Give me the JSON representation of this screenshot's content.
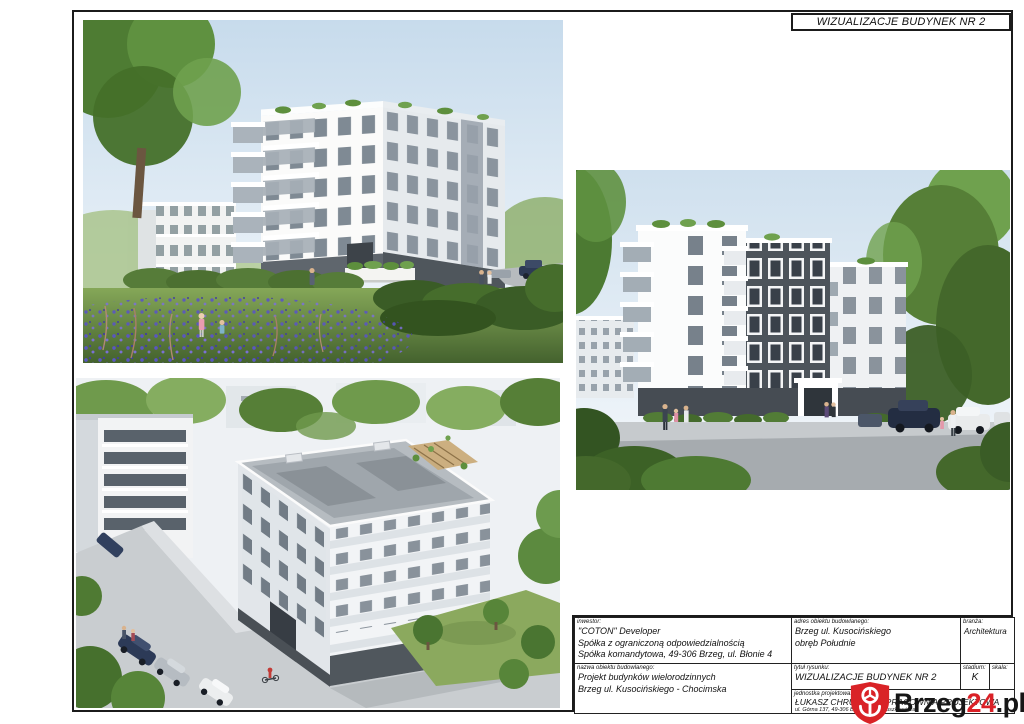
{
  "sheet": {
    "header_title": "WIZUALIZACJE BUDYNEK NR 2"
  },
  "title_block": {
    "investor": {
      "label": "inwestor:",
      "lines": [
        "\"COTON\" Developer",
        "Spółka z ograniczoną odpowiedzialnością",
        "Spółka komandytowa, 49-306 Brzeg, ul. Błonie 4"
      ]
    },
    "address": {
      "label": "adres obiektu budowlanego:",
      "lines": [
        "Brzeg ul. Kusocińskiego",
        "obręb Południe"
      ]
    },
    "branch": {
      "label": "branża:",
      "value": "Architektura"
    },
    "object_name": {
      "label": "nazwa obiektu budowlanego:",
      "lines": [
        "Projekt budynków wielorodzinnych",
        "Brzeg ul. Kusocińskiego - Chocimska"
      ]
    },
    "drawing_title": {
      "label": "tytuł rysunku:",
      "value": "WIZUALIZACJE BUDYNEK NR 2"
    },
    "design_unit": {
      "label": "jednostka projektowa:",
      "value": "ŁUKASZ CHRUŚCICKI PRACOWNIA PROJEKTOWA",
      "address_line": "ul. Górna 137, 49-306 Brzeg, E. Mianuszkiewicza"
    },
    "stage": {
      "label": "stadium:",
      "value": "K"
    },
    "scale": {
      "label": "skala:",
      "value": ""
    }
  },
  "watermark": {
    "black_part1": "Brzeg",
    "red_part": "24",
    "black_part2": ".pl",
    "red_color": "#da2127"
  },
  "figures": [
    {
      "id": "street-view-1",
      "description": "Street-level rendering: white multi-family building with balconies, meadow with wildflowers, hedges and road"
    },
    {
      "id": "aerial-view",
      "description": "Bird's-eye rendering: building no 2 with grey roof at a street corner with parked cars and trees"
    },
    {
      "id": "street-view-2",
      "description": "Street-level rendering: building no 2 with dark brick centre section, balconies, trees and parked cars"
    }
  ],
  "colors": {
    "accent_red": "#da2127",
    "frame_line": "#1b1b1b"
  }
}
